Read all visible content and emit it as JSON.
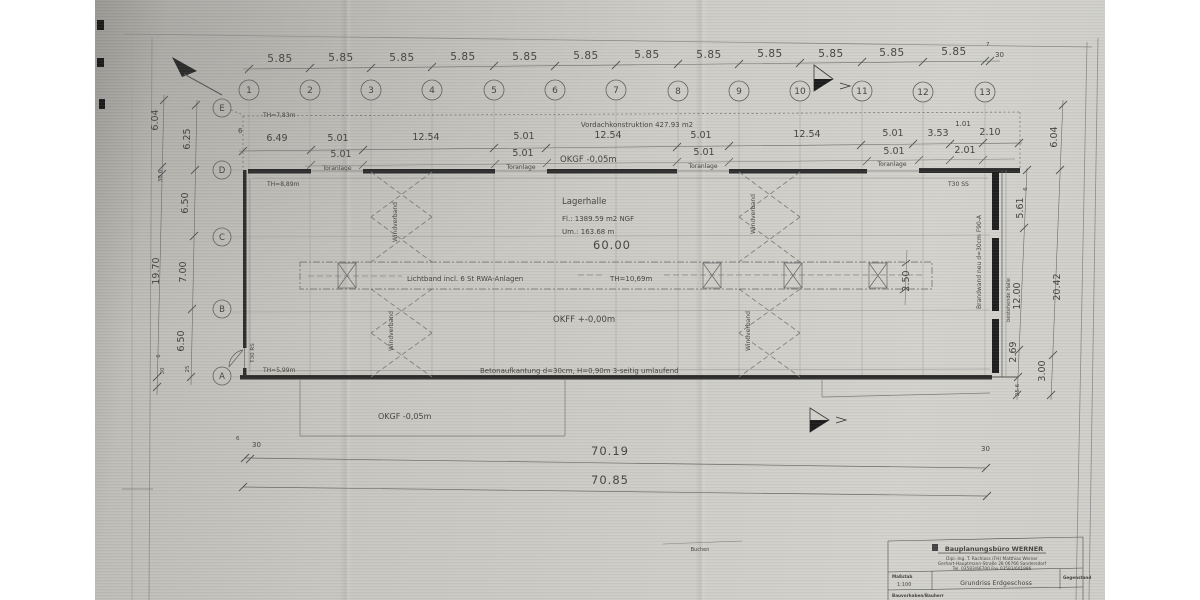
{
  "dims": {
    "top": [
      "5.85",
      "5.85",
      "5.85",
      "5.85",
      "5.85",
      "5.85",
      "5.85",
      "5.85",
      "5.85",
      "5.85",
      "5.85",
      "5.85"
    ],
    "top_end_offset": "30",
    "top_tiny": "7",
    "axes_numbers": [
      "1",
      "2",
      "3",
      "4",
      "5",
      "6",
      "7",
      "8",
      "9",
      "10",
      "11",
      "12",
      "13"
    ],
    "axes_letters": [
      "E",
      "D",
      "C",
      "B",
      "A"
    ],
    "chain2_start": "6",
    "chain2": [
      "6.49",
      "5.01",
      "12.54",
      "5.01",
      "12.54",
      "5.01",
      "12.54",
      "5.01",
      "3.53",
      "1.01",
      "2.10"
    ],
    "chain3": [
      "5.01",
      "5.01",
      "5.01",
      "5.01",
      "2.01"
    ],
    "left_inner": [
      "6.25",
      "6.50",
      "7.00",
      "6.50",
      "25"
    ],
    "left_outer": [
      "6.04",
      "30.6",
      "19.70",
      "6",
      "30"
    ],
    "right_inner": [
      "6",
      "5.61",
      "12.00",
      "2.69",
      "25.6"
    ],
    "right_outer": [
      "6.04",
      "20.42",
      "3.00"
    ],
    "lichtband_height": "2.50",
    "bottom_inner": "70.19",
    "bottom_outer": "70.85",
    "bottom_left_offsets": [
      "6",
      "30"
    ],
    "bottom_right_offset": "30"
  },
  "texts": {
    "vordach": "Vordachkonstruktion 427.93 m2",
    "okgf_top": "OKGF -0,05m",
    "toranlage": "Toranlage",
    "th_e": "TH=7,83m",
    "th_d": "TH=8,89m",
    "th_a": "TH=5,99m",
    "lagerhalle": "Lagerhalle",
    "area": "Fl.: 1389.59 m2 NGF",
    "perimeter": "Um.: 163.68 m",
    "length": "60.00",
    "lichtband": "Lichtband incl. 6 St RWA-Anlagen",
    "lichtband_th": "TH=10,69m",
    "okff": "OKFF +-0,00m",
    "beton": "Betonaufkantung d=30cm, H=0,90m 3-seitig umlaufend",
    "okgf_bottom": "OKGF -0,05m",
    "windverband": "Windverband",
    "brandwand": "Brandwand neu d=30cm F90-A",
    "bestehende_halle": "bestehende Halle",
    "t30_ss": "T30 SS",
    "t30_rs": "T30 RS",
    "buchen": "Buchen"
  },
  "titleblock": {
    "company": "Bauplanungsbüro WERNER",
    "line1": "Dipl.-Ing. T. Rachlass (FH) Matthias Werner",
    "line2": "Gerhart-Hauptmann-Straße 28  06766 Sandersdorf",
    "line3": "Tel. 03583/66700  Fax 03583/601986",
    "scale_label": "Maßstab",
    "scale_value": "1:100",
    "drawing_title": "Grundriss Erdgeschoss",
    "right_label": "Gegenstand",
    "bottom_label": "Bauvorhaben/Bauherr"
  }
}
